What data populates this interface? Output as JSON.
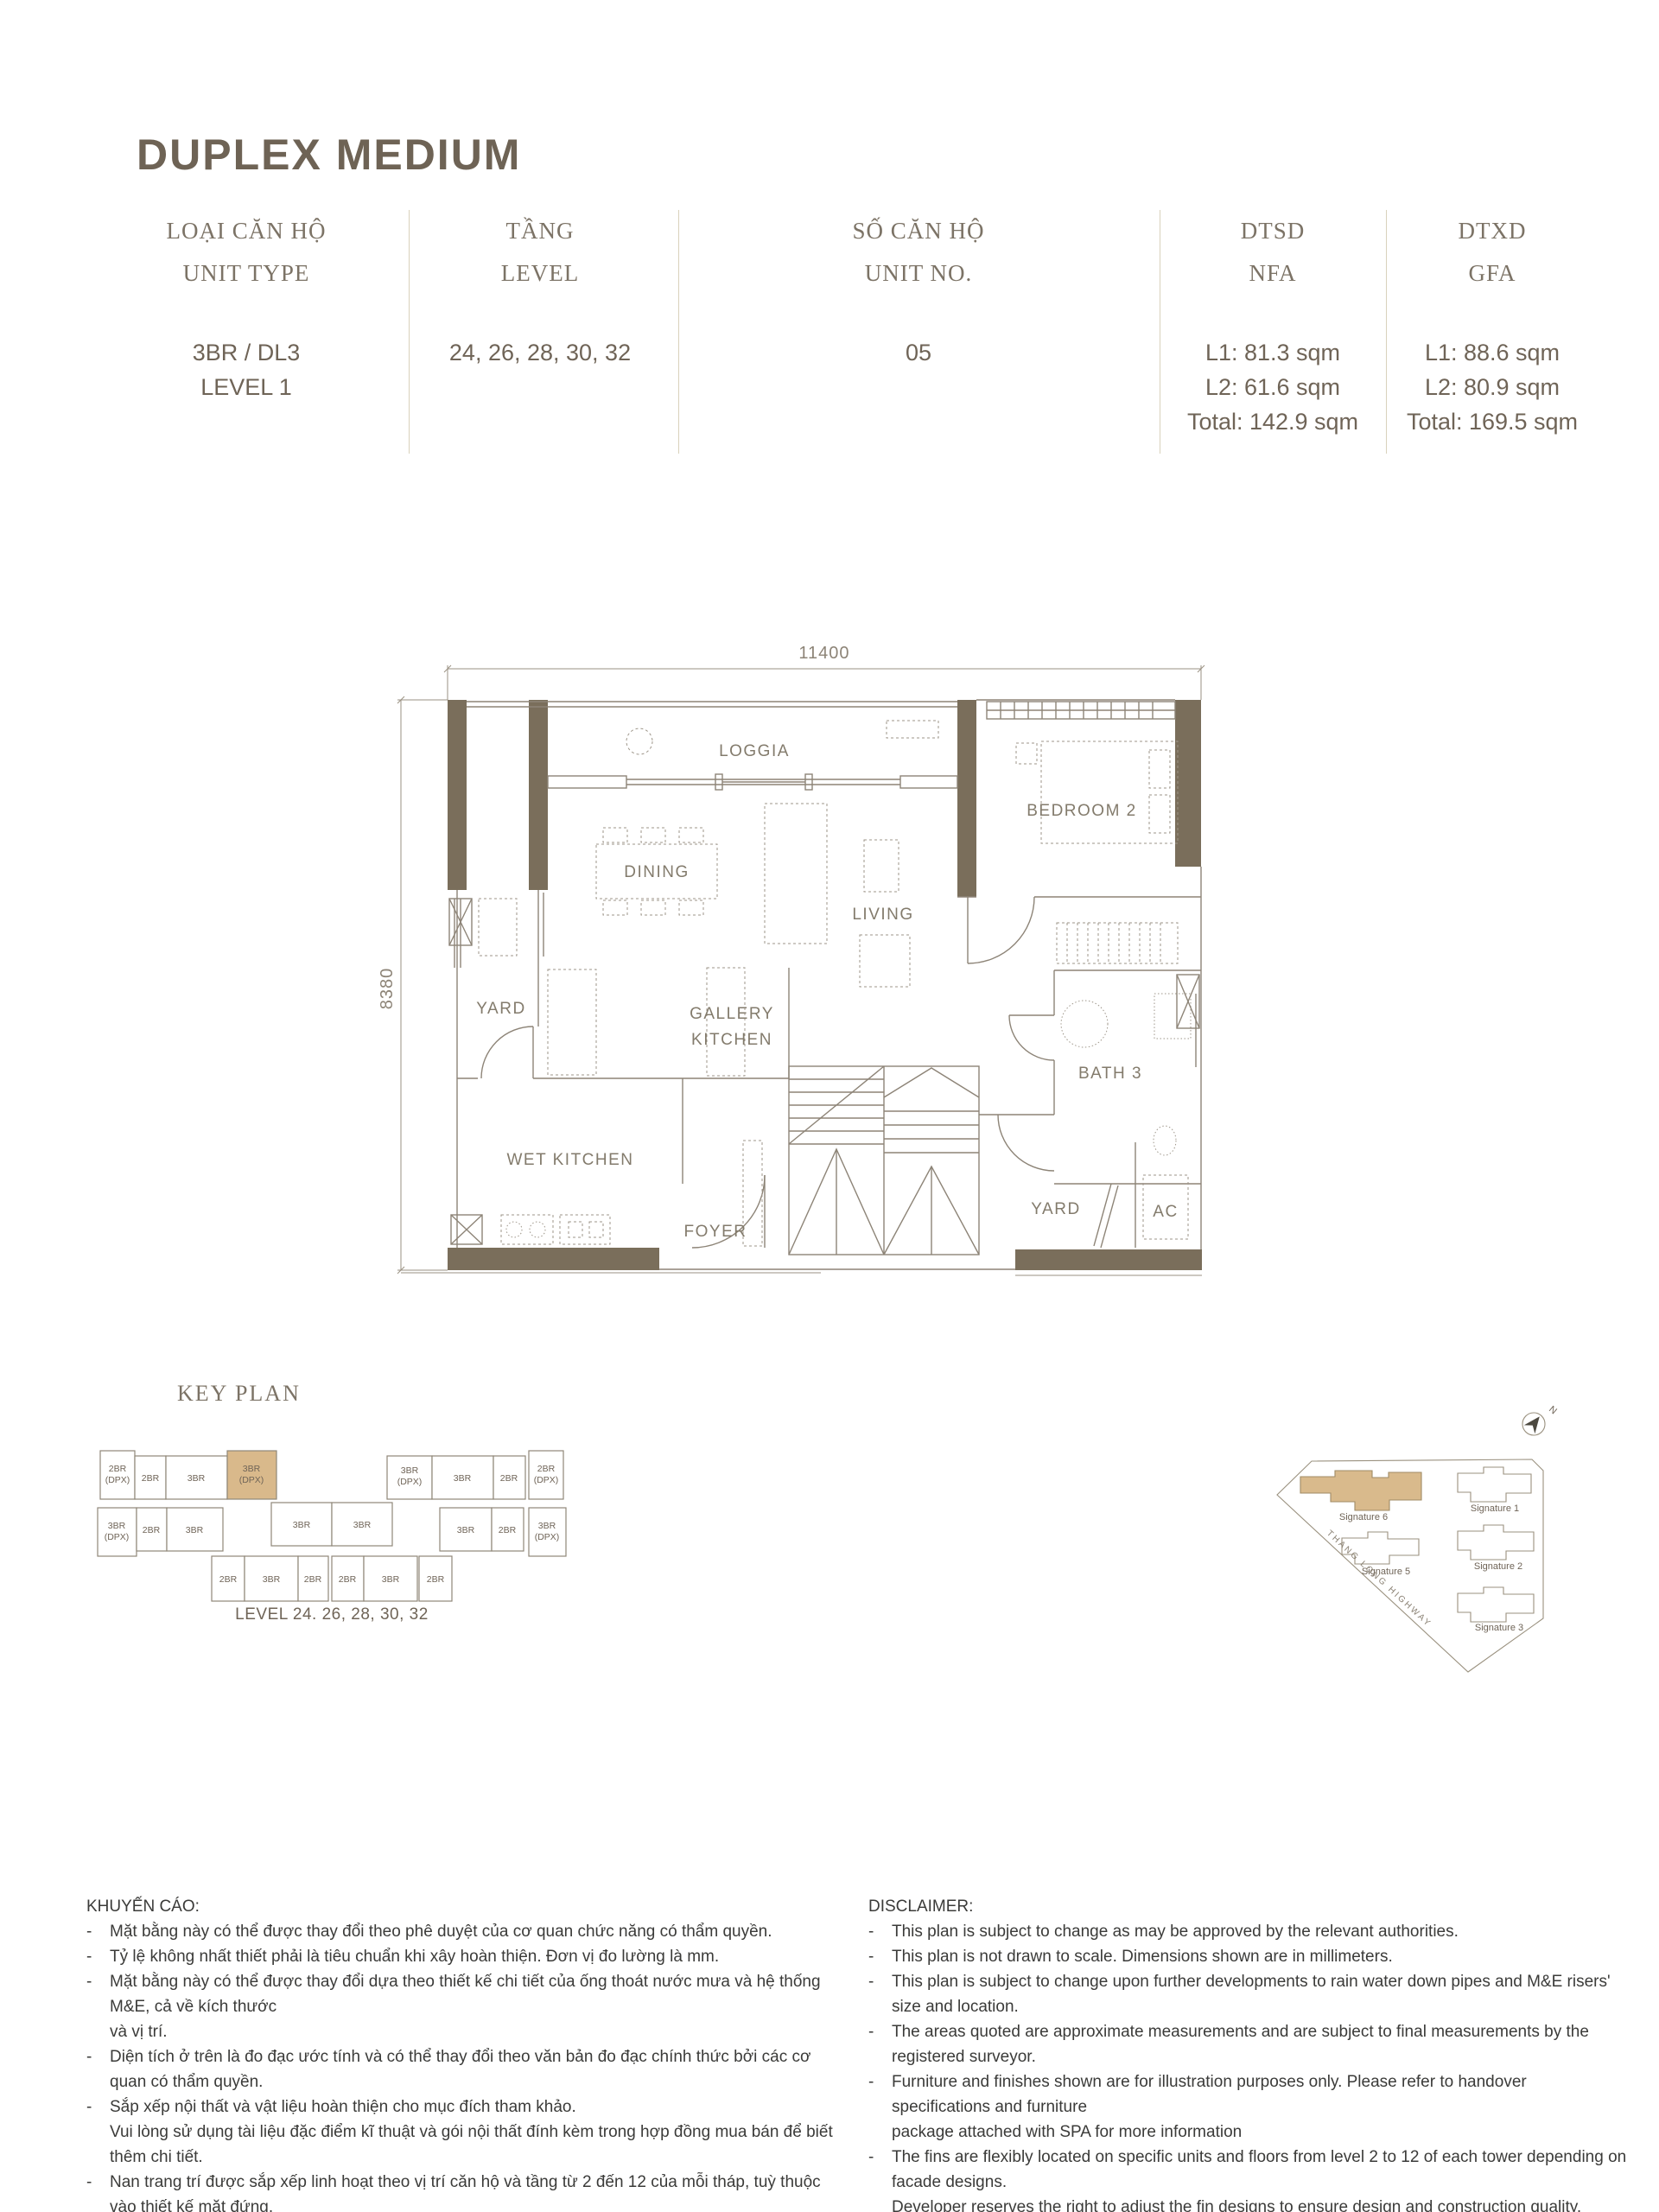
{
  "page": {
    "title": "DUPLEX MEDIUM"
  },
  "colors": {
    "brand_brown": "#6e6355",
    "wall_brown": "#7a6e5b",
    "highlight_tan": "#d9b98b",
    "divider_beige": "#d9d2bc"
  },
  "table": {
    "cols": [
      {
        "vn": "LOẠI CĂN HỘ",
        "en": "UNIT TYPE",
        "v1": "3BR / DL3",
        "v2": "LEVEL 1"
      },
      {
        "vn": "TẦNG",
        "en": "LEVEL",
        "v1": "24, 26, 28, 30, 32"
      },
      {
        "vn": "SỐ CĂN HỘ",
        "en": "UNIT NO.",
        "v1": "05"
      },
      {
        "vn": "DTSD",
        "en": "NFA",
        "v1": "L1: 81.3 sqm",
        "v2": "L2: 61.6 sqm",
        "v3": "Total: 142.9 sqm"
      },
      {
        "vn": "DTXD",
        "en": "GFA",
        "v1": "L1: 88.6 sqm",
        "v2": "L2: 80.9 sqm",
        "v3": "Total: 169.5 sqm"
      }
    ]
  },
  "floor_plan": {
    "dim_width": "11400",
    "dim_height": "8380",
    "labels": {
      "loggia": "LOGGIA",
      "bedroom2": "BEDROOM 2",
      "dining": "DINING",
      "living": "LIVING",
      "yard_left": "YARD",
      "gallery1": "GALLERY",
      "gallery2": "KITCHEN",
      "wet_kitchen": "WET KITCHEN",
      "foyer": "FOYER",
      "bath3": "BATH 3",
      "yard_right": "YARD",
      "ac": "AC"
    }
  },
  "key_plan": {
    "title": "KEY PLAN",
    "level_label": "LEVEL 24. 26, 28, 30, 32",
    "units": [
      {
        "l1": "2BR",
        "l2": "(DPX)"
      },
      {
        "l1": "2BR",
        "l2": ""
      },
      {
        "l1": "3BR",
        "l2": ""
      },
      {
        "l1": "3BR",
        "l2": "(DPX)"
      },
      {
        "l1": "3BR",
        "l2": "(DPX)"
      },
      {
        "l1": "3BR",
        "l2": ""
      },
      {
        "l1": "2BR",
        "l2": ""
      },
      {
        "l1": "2BR",
        "l2": "(DPX)"
      },
      {
        "l1": "3BR",
        "l2": "(DPX)"
      },
      {
        "l1": "2BR",
        "l2": ""
      },
      {
        "l1": "3BR",
        "l2": ""
      },
      {
        "l1": "3BR",
        "l2": ""
      },
      {
        "l1": "3BR",
        "l2": ""
      },
      {
        "l1": "3BR",
        "l2": ""
      },
      {
        "l1": "2BR",
        "l2": ""
      },
      {
        "l1": "3BR",
        "l2": "(DPX)"
      },
      {
        "l1": "2BR",
        "l2": ""
      },
      {
        "l1": "3BR",
        "l2": ""
      },
      {
        "l1": "2BR",
        "l2": ""
      },
      {
        "l1": "2BR",
        "l2": ""
      },
      {
        "l1": "3BR",
        "l2": ""
      },
      {
        "l1": "2BR",
        "l2": ""
      }
    ],
    "highlighted_unit": "3BR (DPX)"
  },
  "site_plan": {
    "north": "N",
    "highway": "THANG LONG HIGHWAY",
    "buildings": [
      "Signature 6",
      "Signature 1",
      "Signature 5",
      "Signature 2",
      "Signature 3"
    ],
    "highlighted": "Signature 6"
  },
  "advisory": {
    "heading": "KHUYẾN CÁO:",
    "lines": [
      {
        "b": "-",
        "t": "Mặt bằng này có thể được thay đổi theo phê duyệt của cơ quan chức năng có thẩm quyền."
      },
      {
        "b": "-",
        "t": "Tỷ lệ không nhất thiết phải là tiêu chuẩn khi xây hoàn thiện. Đơn vị đo lường là mm."
      },
      {
        "b": "-",
        "t": "Mặt bằng này có thể được thay đổi dựa theo thiết kế chi tiết của ống thoát nước mưa và hệ thống M&E, cả về kích thước"
      },
      {
        "b": "",
        "t": "và vị trí."
      },
      {
        "b": "-",
        "t": "Diện tích ở trên là đo đạc ước tính và có thể thay đổi theo văn bản đo đạc chính thức bởi các cơ quan có thẩm quyền."
      },
      {
        "b": "-",
        "t": "Sắp xếp nội thất và vật liệu hoàn thiện cho mục đích tham khảo."
      },
      {
        "b": "",
        "t": "Vui lòng sử dụng tài liệu đặc điểm kĩ thuật và gói nội thất  đính kèm trong hợp đồng mua bán để biết thêm chi tiết."
      },
      {
        "b": "-",
        "t": "Nan trang trí được sắp xếp linh hoạt theo vị trí căn hộ và tầng từ 2 đến 12 của mỗi tháp, tuỳ thuộc vào thiết kế mặt đứng."
      },
      {
        "b": "",
        "t": "Chủ đầu tư có quyền điều chỉnh vị trí các nan trang trí này để đảm bảo chất lượng thiết kế và xây dựng của dự án. Vị trí"
      },
      {
        "b": "",
        "t": "nan trang trí cụ thể của từng căn sẽ được cung cấp tại phụ lục của TTKQ/HĐMB."
      }
    ]
  },
  "disclaimer": {
    "heading": "DISCLAIMER:",
    "lines": [
      {
        "b": "-",
        "t": "This plan is subject to change as may be approved by the relevant authorities."
      },
      {
        "b": "-",
        "t": "This plan is not drawn to scale. Dimensions shown are in millimeters."
      },
      {
        "b": "-",
        "t": "This plan is subject to change upon further developments to rain water down pipes and M&E risers' size and location."
      },
      {
        "b": "-",
        "t": "The areas quoted are approximate measurements and are subject to final measurements by the registered surveyor."
      },
      {
        "b": "-",
        "t": "Furniture and finishes shown are for illustration purposes only. Please refer to handover specifications and furniture"
      },
      {
        "b": "",
        "t": "package attached with SPA for more information"
      },
      {
        "b": "-",
        "t": "The fins are flexibly located on specific units and floors from level 2 to 12 of each tower depending on facade designs."
      },
      {
        "b": "",
        "t": "Developer reserves the right to adjust the fin designs to ensure design and construction quality. Detailed fin location for"
      },
      {
        "b": "",
        "t": "each unit shall be provided in the appendix of EA/SPA."
      }
    ]
  }
}
